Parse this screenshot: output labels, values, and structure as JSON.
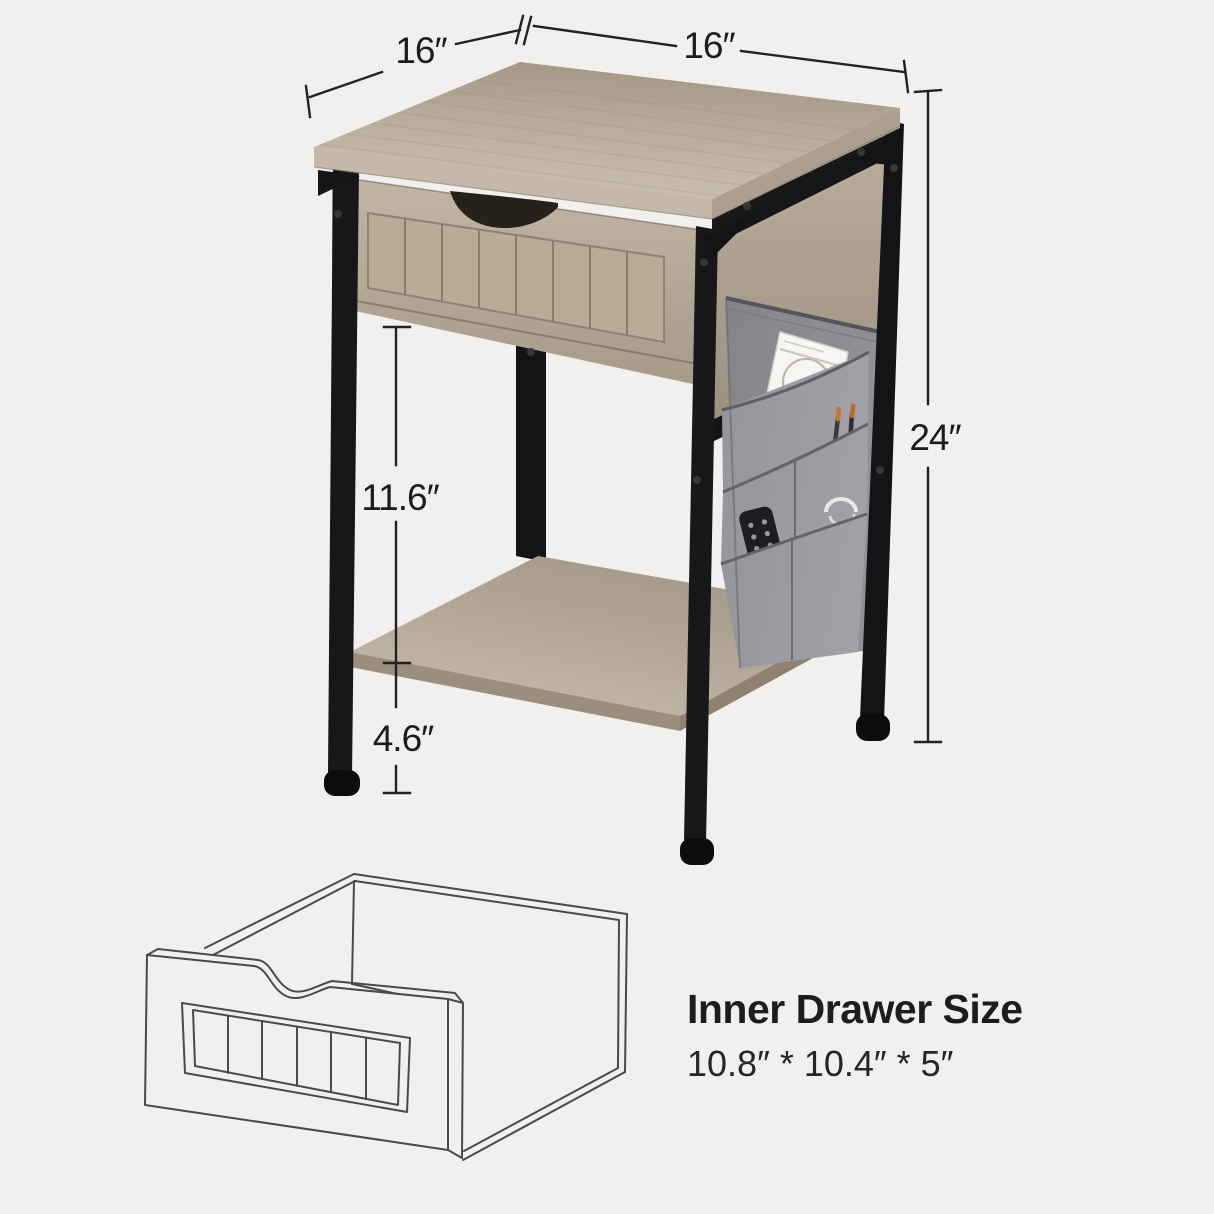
{
  "canvas": {
    "width": "1214",
    "height": "1214",
    "background": "#f1f0ee"
  },
  "dimensions": {
    "top_depth": "16″",
    "top_width": "16″",
    "overall_height": "24″",
    "open_shelf_clearance": "11.6″",
    "shelf_to_floor": "4.6″"
  },
  "inner_drawer": {
    "title": "Inner Drawer Size",
    "size": "10.8″ * 10.4″ * 5″"
  },
  "illustration": {
    "subject": "nightstand with drawer, open shelf and side fabric storage caddy",
    "caddy_items": [
      "book",
      "pens",
      "remote-control",
      "earphone-cable"
    ],
    "colors": {
      "wood_light": "#cbc1b3",
      "wood_mid": "#b5a898",
      "wood_dark": "#a39682",
      "metal_black": "#17171a",
      "fabric_gray": "#8b8c92",
      "fabric_pocket_gray": "#9a9ba1",
      "dimension_line": "#222222",
      "text_color": "#1d1d1d",
      "line_art_stroke": "#4a4a4a"
    }
  }
}
